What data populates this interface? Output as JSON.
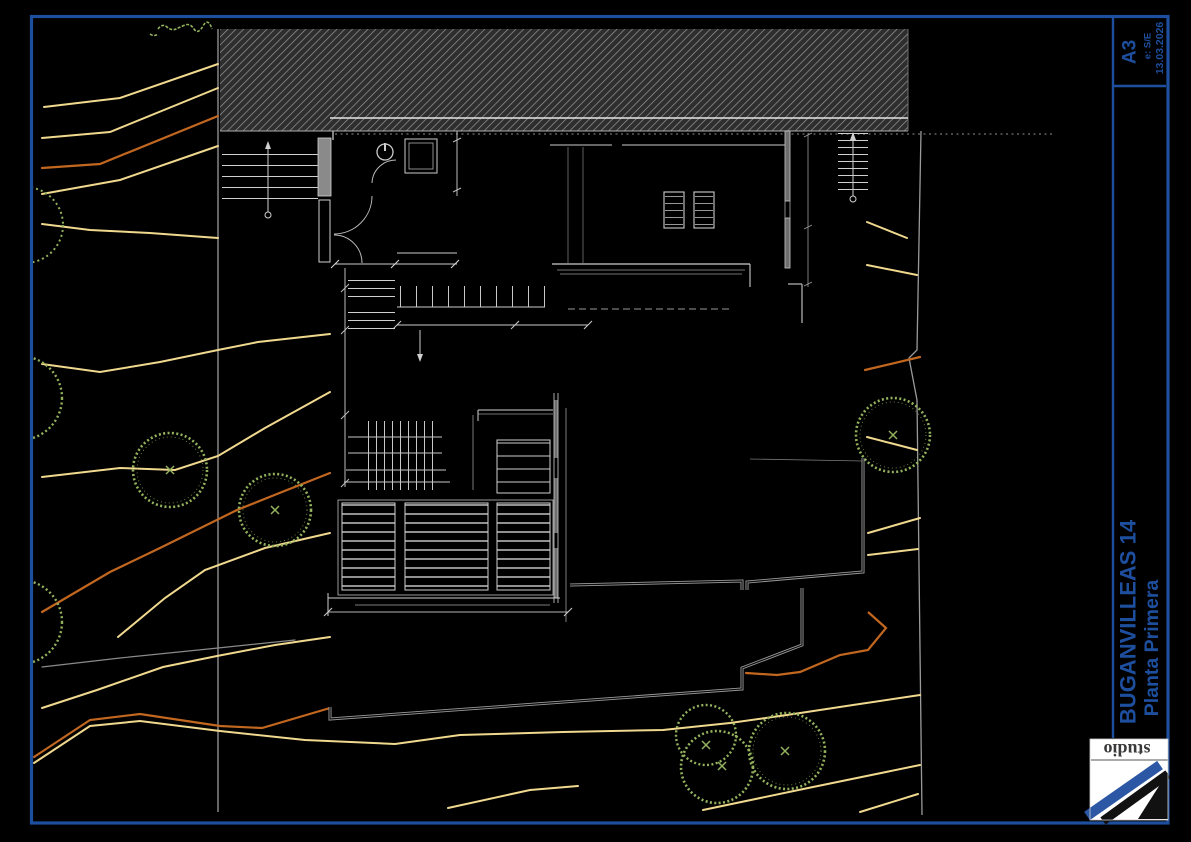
{
  "sheet": {
    "project": "BUGANVILLEAS 14",
    "plan_title": "Planta Primera",
    "paper_size": "A3",
    "scale": "e: S/E",
    "date": "13.03.2026",
    "logo_text": "studio"
  },
  "colors": {
    "frame_blue": "#1e4f9e",
    "contour_yellow": "#f0d98e",
    "contour_orange": "#c2671f",
    "contour_gray": "#8a8a8a",
    "tree_green": "#93b25d",
    "plan_line_gray": "#9a9a9a",
    "plan_line_white": "#d9d9d9",
    "paper_background": "#000000",
    "logo_background": "#ffffff"
  }
}
